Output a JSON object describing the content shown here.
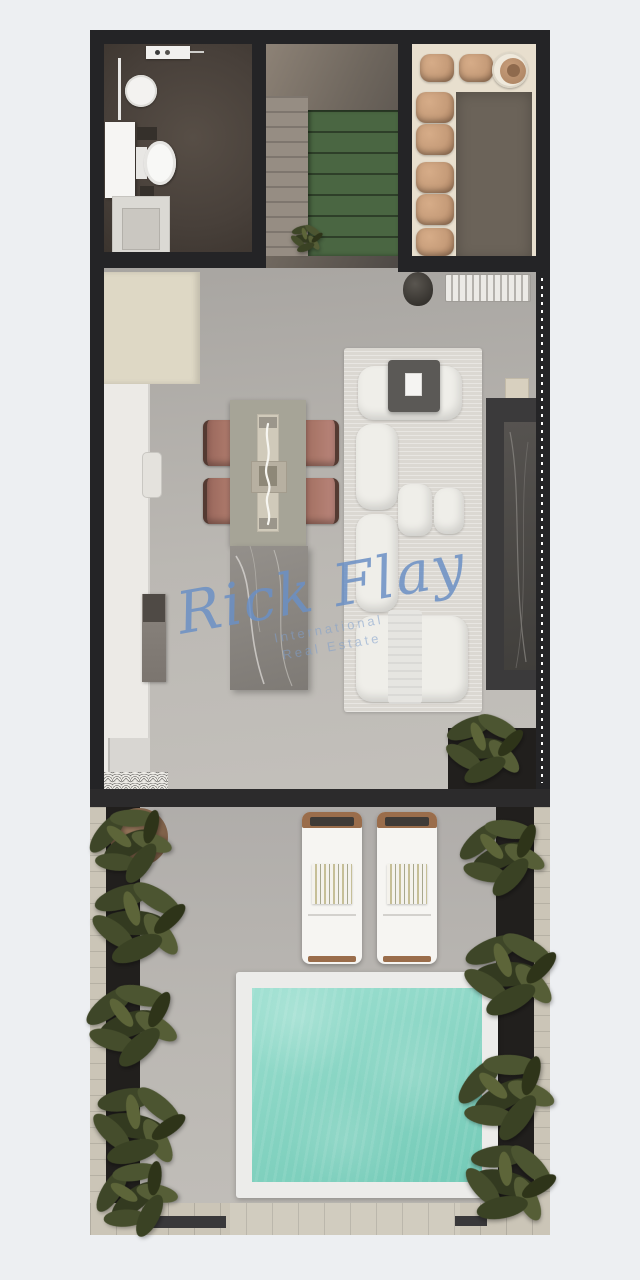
{
  "watermark": {
    "signature": "Rick Flay",
    "subtitle_line1": "International",
    "subtitle_line2": "Real Estate"
  },
  "palette": {
    "wall": "#242426",
    "hall": "#6f675e",
    "stair": "#4a6642",
    "bath_floor": "#48403a",
    "room_floor": "#e8dfce",
    "rug_dark": "#6b6359",
    "pouf": "#c69c79",
    "table": "#a6a497",
    "runner": "#d0caba",
    "chair": "#a97668",
    "island": "#8b8782",
    "sofa": "#efeee9",
    "sofa_rug": "#dbd8d2",
    "tv_wall": "#3b3a3b",
    "marble": "#4c4a47",
    "cabinet": "#ded8c5",
    "counter": "#eceae6",
    "pool": "#85d3c1",
    "coping": "#ececea",
    "deck": "#cbc5b7",
    "planter": "#211f1d",
    "plant": "#47502e",
    "lounger_wood": "#9a6d4b",
    "signature": "#6b90c5",
    "subtitle": "#7f9fcc"
  }
}
